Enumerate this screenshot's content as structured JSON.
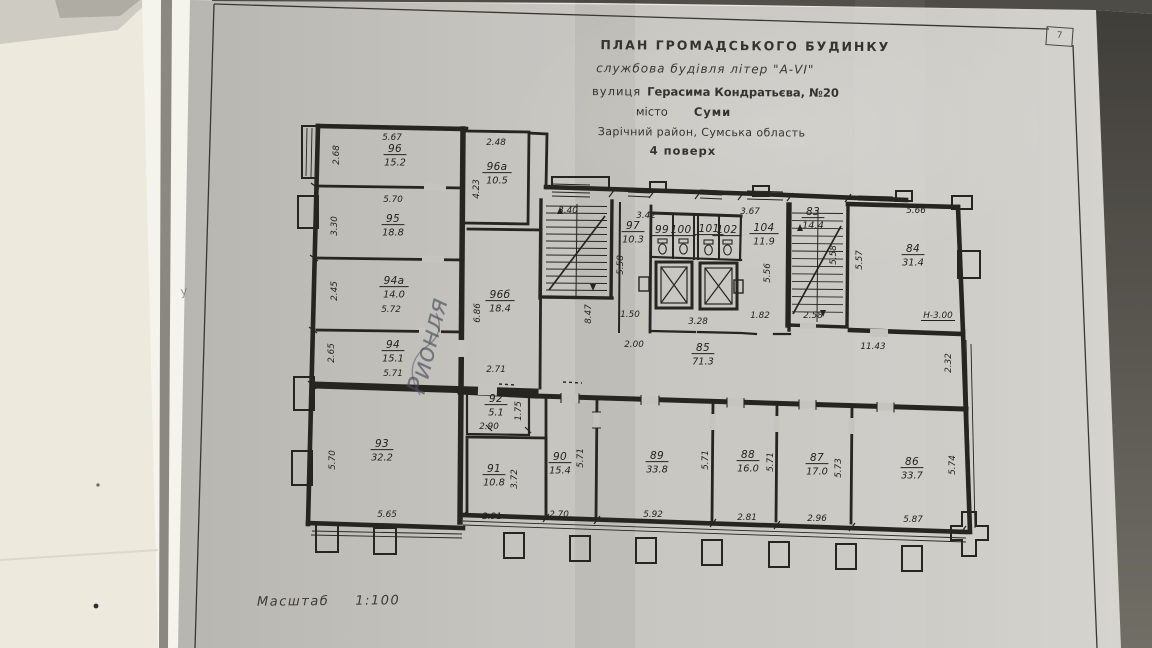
{
  "document": {
    "title_block": {
      "line1": "ПЛАН  ГРОМАДСЬКОГО  БУДИНКУ",
      "line2": "службова будівля літер \"А-VI\"",
      "line3_label": "вулиця",
      "line3_value": "Герасима Кондратьєва, №20",
      "line4_label": "місто",
      "line4_value": "Суми",
      "line5": "Зарічний район, Сумська область",
      "line6": "4 поверх",
      "corner_mark": "7"
    },
    "scale": {
      "label": "Масштаб",
      "value": "1:100"
    },
    "handwriting": {
      "text": "Рионля",
      "small_mark": "у"
    }
  },
  "colors": {
    "paper": "#c6c4bf",
    "ink": "#23221f",
    "wall_cream": "#ede9dc",
    "shadow_band": "#8a8880",
    "table_dark": "#4a4843",
    "pen_blue": "#474e5c"
  },
  "plan": {
    "rooms": [
      {
        "num": "96",
        "area": "15.2",
        "x": 395,
        "y": 152
      },
      {
        "num": "96а",
        "area": "10.5",
        "x": 497,
        "y": 170
      },
      {
        "num": "95",
        "area": "18.8",
        "x": 393,
        "y": 222
      },
      {
        "num": "94а",
        "area": "14.0",
        "x": 394,
        "y": 284
      },
      {
        "num": "96б",
        "area": "18.4",
        "x": 500,
        "y": 298
      },
      {
        "num": "94",
        "area": "15.1",
        "x": 393,
        "y": 348
      },
      {
        "num": "93",
        "area": "32.2",
        "x": 382,
        "y": 447
      },
      {
        "num": "92",
        "area": "5.1",
        "x": 496,
        "y": 402
      },
      {
        "num": "91",
        "area": "10.8",
        "x": 494,
        "y": 472
      },
      {
        "num": "97",
        "area": "10.3",
        "x": 633,
        "y": 229
      },
      {
        "num": "99",
        "area": null,
        "x": 662,
        "y": 233
      },
      {
        "num": "100",
        "area": null,
        "x": 681,
        "y": 233
      },
      {
        "num": "101",
        "area": null,
        "x": 709,
        "y": 232
      },
      {
        "num": "102",
        "area": null,
        "x": 727,
        "y": 233
      },
      {
        "num": "104",
        "area": "11.9",
        "x": 764,
        "y": 231
      },
      {
        "num": "83",
        "area": "14.4",
        "x": 813,
        "y": 215
      },
      {
        "num": "84",
        "area": "31.4",
        "x": 913,
        "y": 252
      },
      {
        "num": "85",
        "area": "71.3",
        "x": 703,
        "y": 351
      },
      {
        "num": "90",
        "area": "15.4",
        "x": 560,
        "y": 460
      },
      {
        "num": "89",
        "area": "33.8",
        "x": 657,
        "y": 459
      },
      {
        "num": "88",
        "area": "16.0",
        "x": 748,
        "y": 458
      },
      {
        "num": "87",
        "area": "17.0",
        "x": 817,
        "y": 461
      },
      {
        "num": "86",
        "area": "33.7",
        "x": 912,
        "y": 465
      }
    ],
    "dims": [
      {
        "t": "5.67",
        "x": 392,
        "y": 140
      },
      {
        "t": "2.48",
        "x": 496,
        "y": 145
      },
      {
        "t": "5.70",
        "x": 393,
        "y": 202
      },
      {
        "t": "3.40",
        "x": 568,
        "y": 213
      },
      {
        "t": "3.42",
        "x": 646,
        "y": 218
      },
      {
        "t": "3.67",
        "x": 750,
        "y": 214
      },
      {
        "t": "5.66",
        "x": 916,
        "y": 213
      },
      {
        "t": "5.72",
        "x": 391,
        "y": 312
      },
      {
        "t": "5.71",
        "x": 393,
        "y": 376
      },
      {
        "t": "2.71",
        "x": 496,
        "y": 372
      },
      {
        "t": "1.50",
        "x": 630,
        "y": 317
      },
      {
        "t": "3.28",
        "x": 698,
        "y": 324
      },
      {
        "t": "1.82",
        "x": 760,
        "y": 318
      },
      {
        "t": "2.58",
        "x": 813,
        "y": 318
      },
      {
        "t": "Н-3.00",
        "x": 938,
        "y": 318,
        "u": true
      },
      {
        "t": "2.00",
        "x": 634,
        "y": 347
      },
      {
        "t": "11.43",
        "x": 873,
        "y": 349
      },
      {
        "t": "2.90",
        "x": 489,
        "y": 429
      },
      {
        "t": "5.65",
        "x": 387,
        "y": 517
      },
      {
        "t": "2.91",
        "x": 492,
        "y": 519
      },
      {
        "t": "2.70",
        "x": 559,
        "y": 517
      },
      {
        "t": "5.92",
        "x": 653,
        "y": 517
      },
      {
        "t": "2.81",
        "x": 747,
        "y": 520
      },
      {
        "t": "2.96",
        "x": 817,
        "y": 521
      },
      {
        "t": "5.87",
        "x": 913,
        "y": 522
      },
      {
        "t": "2.68",
        "x": 339,
        "y": 155,
        "v": true
      },
      {
        "t": "4.23",
        "x": 479,
        "y": 189,
        "v": true
      },
      {
        "t": "3.30",
        "x": 337,
        "y": 226,
        "v": true
      },
      {
        "t": "2.45",
        "x": 337,
        "y": 291,
        "v": true
      },
      {
        "t": "6.86",
        "x": 480,
        "y": 313,
        "v": true
      },
      {
        "t": "2.65",
        "x": 334,
        "y": 353,
        "v": true
      },
      {
        "t": "5.70",
        "x": 335,
        "y": 460,
        "v": true
      },
      {
        "t": "8.47",
        "x": 591,
        "y": 314,
        "v": true
      },
      {
        "t": "5.58",
        "x": 623,
        "y": 265,
        "v": true
      },
      {
        "t": "5.56",
        "x": 770,
        "y": 273,
        "v": true
      },
      {
        "t": "5.58",
        "x": 836,
        "y": 255,
        "v": true
      },
      {
        "t": "5.57",
        "x": 862,
        "y": 260,
        "v": true
      },
      {
        "t": "2.32",
        "x": 951,
        "y": 363,
        "v": true
      },
      {
        "t": "1.75",
        "x": 521,
        "y": 411,
        "v": true
      },
      {
        "t": "3.72",
        "x": 517,
        "y": 479,
        "v": true
      },
      {
        "t": "5.71",
        "x": 583,
        "y": 458,
        "v": true
      },
      {
        "t": "5.71",
        "x": 708,
        "y": 460,
        "v": true
      },
      {
        "t": "5.71",
        "x": 773,
        "y": 462,
        "v": true
      },
      {
        "t": "5.73",
        "x": 841,
        "y": 468,
        "v": true
      },
      {
        "t": "5.74",
        "x": 955,
        "y": 465,
        "v": true
      }
    ]
  }
}
